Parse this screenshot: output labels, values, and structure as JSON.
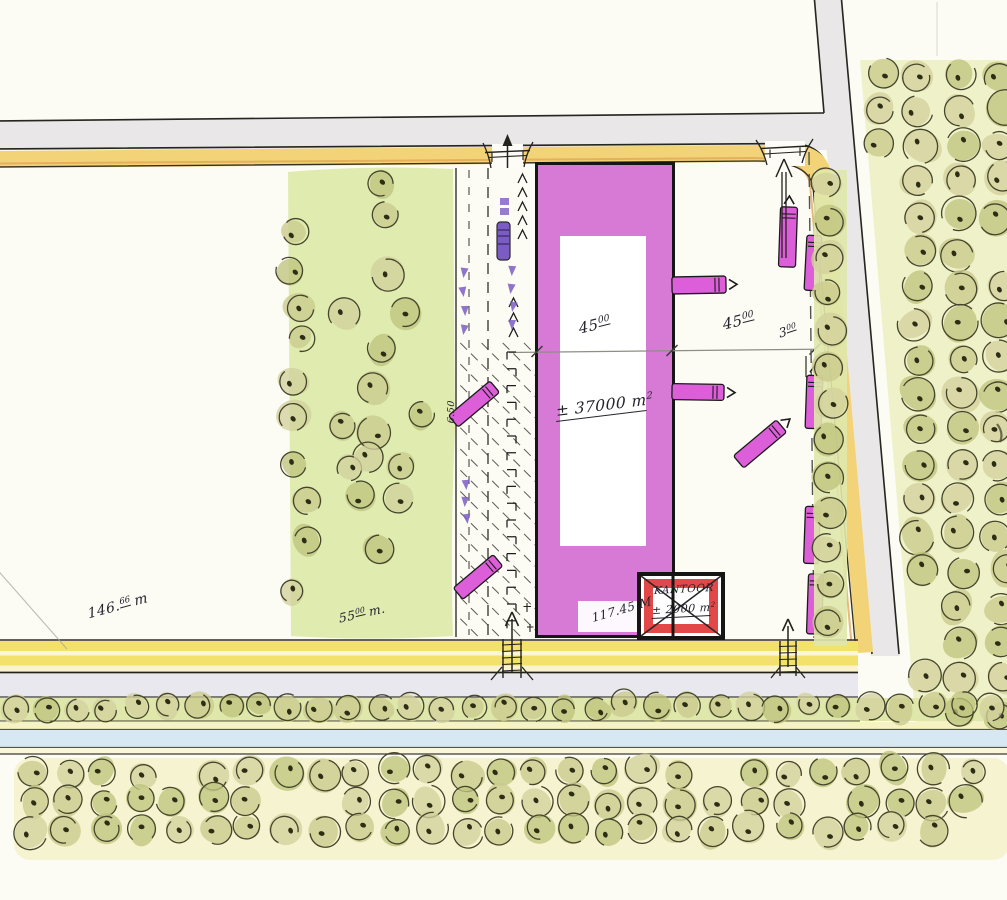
{
  "colors": {
    "paper": "#fcfbf4",
    "road_gray": "#e9e7e8",
    "boundary_yellow": "#f2d377",
    "bottom_yellow": "#f2e26b",
    "magenta": "#d36fd3",
    "truck_magenta": "#dc5ed8",
    "kantoor_red": "#e34848",
    "car_purple": "#7b5cc4",
    "canal_blue": "#d8e8f2",
    "green_wash": "#dde9a8",
    "verge_green": "#dfe7ab",
    "grid_wash": "#eef1c6",
    "grove_wash": "#f5f3cd",
    "tree_fills": [
      "#c9cb8c",
      "#bfc47e",
      "#d2d19c"
    ],
    "tree_stroke": "#45452c",
    "tree_dot": "#2d2d15",
    "ink": "#23222a"
  },
  "labels": {
    "dim_left": {
      "main": "45",
      "sup": "00"
    },
    "dim_right": {
      "main": "45",
      "sup": "00"
    },
    "dim_small": {
      "main": "3",
      "sup": "00"
    },
    "area_main": {
      "main": "± 37000 m",
      "sup": "2"
    },
    "kantoor": {
      "name": "KANTOOR",
      "area_main": "± 2000 m",
      "area_sup": "2"
    },
    "dim_front": {
      "main": "146.",
      "sup": "66",
      "unit": "m"
    },
    "dim_green": {
      "main": "55",
      "sup": "00",
      "unit": "m."
    },
    "dim_plot": "117.45 M",
    "strip_width": "6.50"
  }
}
